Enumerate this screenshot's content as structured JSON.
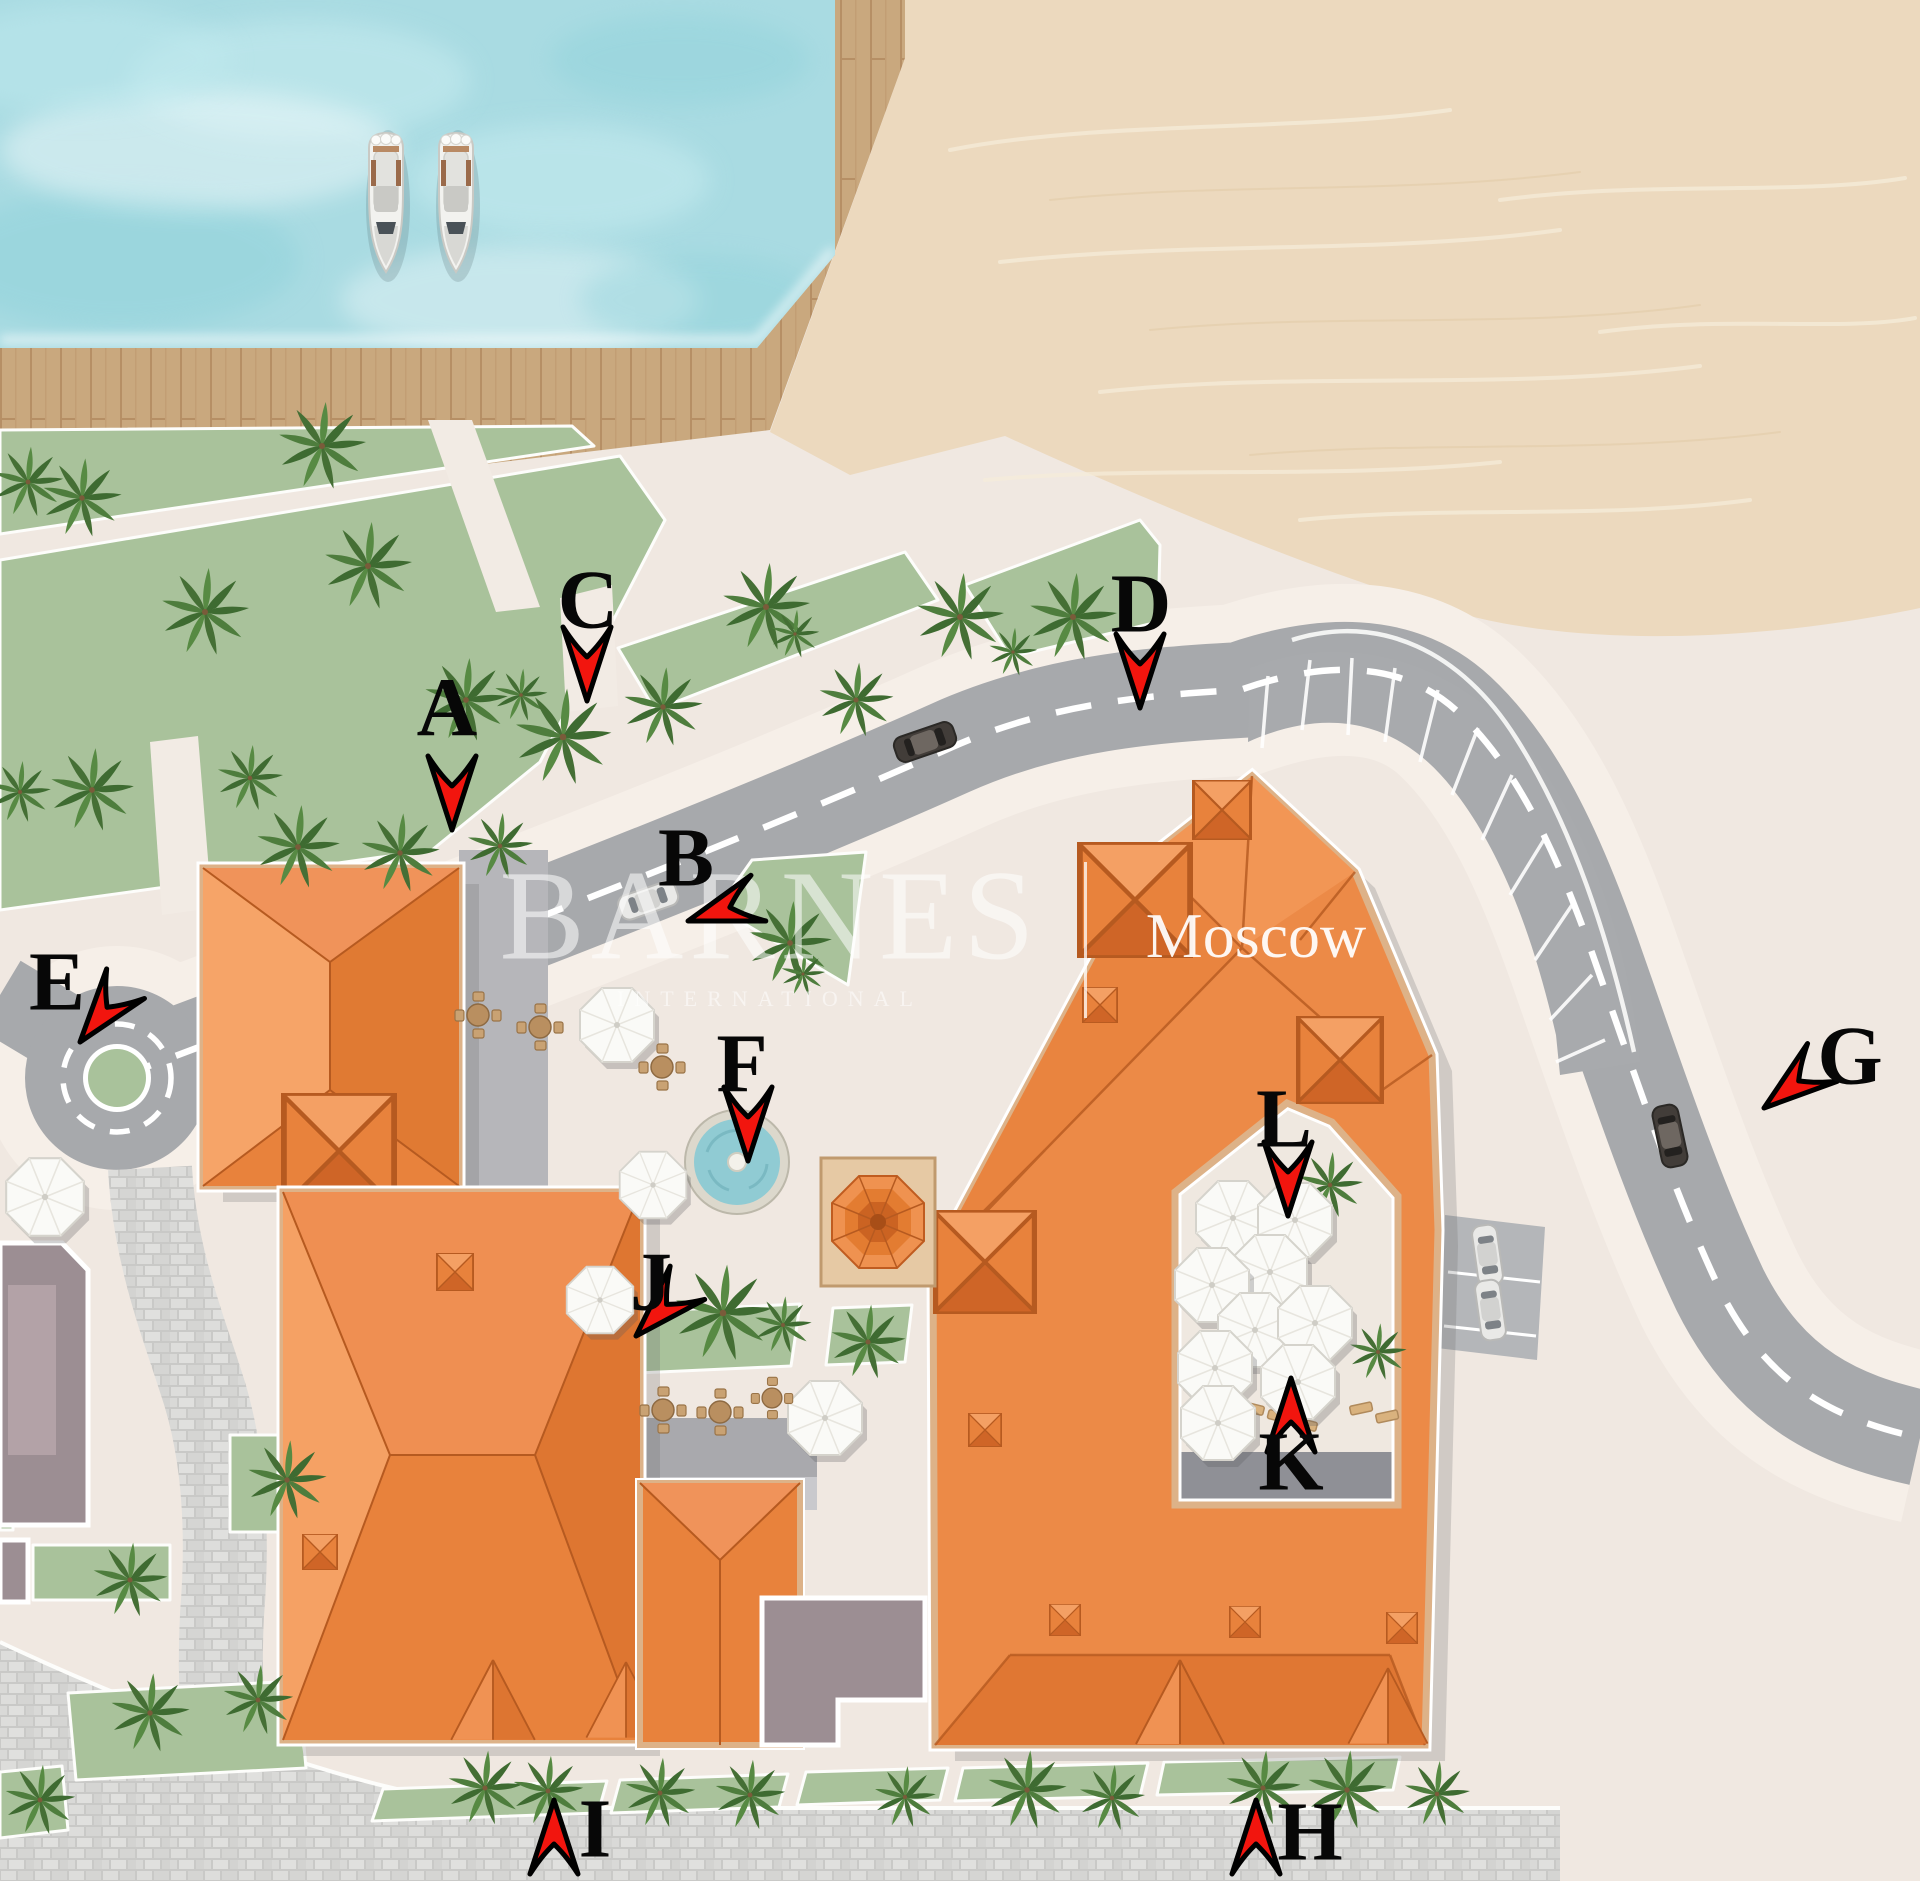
{
  "map": {
    "watermark": {
      "brand": "BARNES",
      "subtitle": "INTERNATIONAL",
      "divider": "|",
      "location": "Moscow"
    },
    "markers": [
      {
        "label": "A",
        "lx": 447,
        "ly": 712,
        "tx": 452,
        "ty": 830,
        "rot": 0
      },
      {
        "label": "B",
        "lx": 686,
        "ly": 862,
        "tx": 688,
        "ty": 921,
        "rot": 72
      },
      {
        "label": "C",
        "lx": 588,
        "ly": 604,
        "tx": 587,
        "ty": 701,
        "rot": 0
      },
      {
        "label": "D",
        "lx": 1141,
        "ly": 608,
        "tx": 1140,
        "ty": 708,
        "rot": 0
      },
      {
        "label": "E",
        "lx": 57,
        "ly": 986,
        "tx": 80,
        "ty": 1042,
        "rot": 38
      },
      {
        "label": "F",
        "lx": 742,
        "ly": 1068,
        "tx": 748,
        "ty": 1161,
        "rot": 0
      },
      {
        "label": "G",
        "lx": 1850,
        "ly": 1060,
        "tx": 1764,
        "ty": 1108,
        "rot": 52
      },
      {
        "label": "H",
        "lx": 1310,
        "ly": 1836,
        "tx": 1256,
        "ty": 1800,
        "rot": 180
      },
      {
        "label": "I",
        "lx": 595,
        "ly": 1833,
        "tx": 554,
        "ty": 1800,
        "rot": 180
      },
      {
        "label": "J",
        "lx": 651,
        "ly": 1286,
        "tx": 636,
        "ty": 1336,
        "rot": 44
      },
      {
        "label": "K",
        "lx": 1291,
        "ly": 1466,
        "tx": 1291,
        "ty": 1378,
        "rot": 180
      },
      {
        "label": "L",
        "lx": 1284,
        "ly": 1123,
        "tx": 1288,
        "ty": 1216,
        "rot": 0
      }
    ],
    "colors": {
      "marker_red": "#f2150e",
      "marker_outline": "#000000",
      "letter": "#070707",
      "water": "#a9dbe2",
      "sand": "#ecd9be",
      "dock_wood": "#c9a87e",
      "road": "#a7a9ac",
      "lane_line": "#ffffff",
      "green": "#a9c29b",
      "roof_orange": "#ec8a47",
      "roof_dark": "#dd7531",
      "cream": "#f0e8e1",
      "cobblestone": "#d8d8d6",
      "taupe": "#9c8e93"
    },
    "decor": {
      "palms": [
        [
          28,
          482,
          0.8
        ],
        [
          82,
          498,
          0.9
        ],
        [
          205,
          612,
          1
        ],
        [
          322,
          446,
          1
        ],
        [
          368,
          566,
          1
        ],
        [
          466,
          700,
          0.95
        ],
        [
          521,
          695,
          0.6
        ],
        [
          563,
          737,
          1.1
        ],
        [
          663,
          707,
          0.9
        ],
        [
          766,
          607,
          1
        ],
        [
          795,
          634,
          0.55
        ],
        [
          960,
          617,
          1
        ],
        [
          1073,
          617,
          1
        ],
        [
          1013,
          652,
          0.55
        ],
        [
          856,
          700,
          0.85
        ],
        [
          20,
          792,
          0.7
        ],
        [
          92,
          790,
          0.95
        ],
        [
          250,
          778,
          0.75
        ],
        [
          298,
          847,
          0.95
        ],
        [
          400,
          853,
          0.9
        ],
        [
          500,
          846,
          0.75
        ],
        [
          790,
          943,
          0.95
        ],
        [
          803,
          974,
          0.5
        ],
        [
          1330,
          1185,
          0.75
        ],
        [
          1378,
          1352,
          0.65
        ],
        [
          723,
          1313,
          1.1
        ],
        [
          783,
          1325,
          0.65
        ],
        [
          868,
          1342,
          0.85
        ],
        [
          485,
          1788,
          0.85
        ],
        [
          548,
          1791,
          0.8
        ],
        [
          660,
          1793,
          0.8
        ],
        [
          750,
          1795,
          0.8
        ],
        [
          905,
          1797,
          0.7
        ],
        [
          1027,
          1790,
          0.9
        ],
        [
          1112,
          1798,
          0.75
        ],
        [
          1263,
          1788,
          0.85
        ],
        [
          1347,
          1790,
          0.9
        ],
        [
          1437,
          1794,
          0.75
        ],
        [
          287,
          1480,
          0.9
        ],
        [
          130,
          1580,
          0.85
        ],
        [
          150,
          1713,
          0.9
        ],
        [
          258,
          1700,
          0.8
        ],
        [
          40,
          1800,
          0.8
        ]
      ],
      "umbrellas": [
        [
          617,
          1025,
          1
        ],
        [
          653,
          1185,
          0.9
        ],
        [
          600,
          1300,
          0.9
        ],
        [
          825,
          1418,
          1
        ],
        [
          45,
          1197,
          1.05
        ],
        [
          1233,
          1218,
          1
        ],
        [
          1295,
          1220,
          1
        ],
        [
          1270,
          1272,
          1
        ],
        [
          1212,
          1285,
          1
        ],
        [
          1255,
          1330,
          1
        ],
        [
          1315,
          1323,
          1
        ],
        [
          1215,
          1368,
          1
        ],
        [
          1298,
          1382,
          1
        ],
        [
          1218,
          1423,
          1
        ]
      ],
      "tables": [
        [
          478,
          1015,
          1
        ],
        [
          540,
          1027,
          1
        ],
        [
          662,
          1067,
          1
        ],
        [
          663,
          1410,
          1
        ],
        [
          720,
          1412,
          1
        ],
        [
          772,
          1398,
          0.9
        ]
      ],
      "boats": [
        [
          386,
          200
        ],
        [
          456,
          200
        ]
      ],
      "cars": [
        {
          "x": 925,
          "y": 742,
          "angle": -19,
          "type": "dark"
        },
        {
          "x": 648,
          "y": 900,
          "angle": -19,
          "type": "light"
        },
        {
          "x": 1670,
          "y": 1136,
          "angle": 78,
          "type": "dark"
        },
        {
          "x": 1488,
          "y": 1255,
          "angle": 82,
          "type": "light"
        },
        {
          "x": 1491,
          "y": 1310,
          "angle": 82,
          "type": "light"
        }
      ]
    }
  }
}
